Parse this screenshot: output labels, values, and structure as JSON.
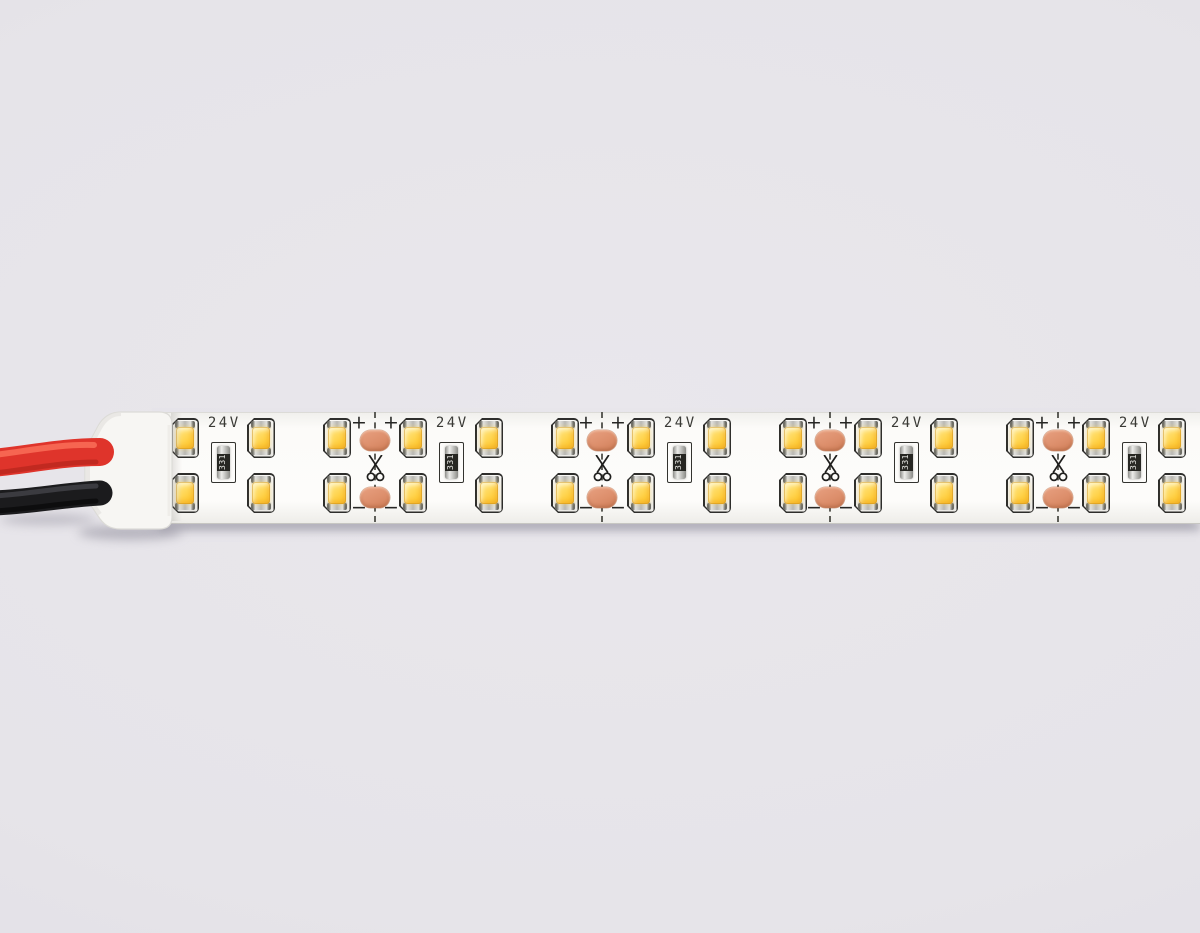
{
  "image": {
    "width": 1200,
    "height": 933
  },
  "strip": {
    "voltage_label": "24V",
    "resistor_code": "331",
    "plus_mark": "+",
    "minus_mark": "−",
    "led_rows": 2,
    "led_columns_x": [
      185,
      261,
      337,
      413,
      489,
      565,
      641,
      717,
      793,
      868,
      944,
      1020,
      1096,
      1172
    ],
    "cut_points_x": [
      375,
      602,
      830,
      1058
    ],
    "resistors_x": [
      223,
      451,
      679,
      906,
      1134
    ],
    "strip_top": 412,
    "strip_height": 110,
    "led_top_cy": 438,
    "led_bottom_cy": 493,
    "pad_top_cy": 440,
    "pad_bottom_cy": 497,
    "plus_cy": 423,
    "minus_cy": 508,
    "mark_dx": 16,
    "scissors_cy": 469,
    "vlabel_cy": 423,
    "resistor_cy": 462
  },
  "colors": {
    "background": "#E6E4E9",
    "pcb_white": "#FCFBF9",
    "led_yellow": "#FFD14A",
    "pad_copper": "#DD8F6C",
    "wire_red": "#E0352B",
    "wire_black": "#1B1B1D",
    "end_cap_white": "#F7F6F3",
    "silkscreen_black": "#2E2E2C"
  }
}
